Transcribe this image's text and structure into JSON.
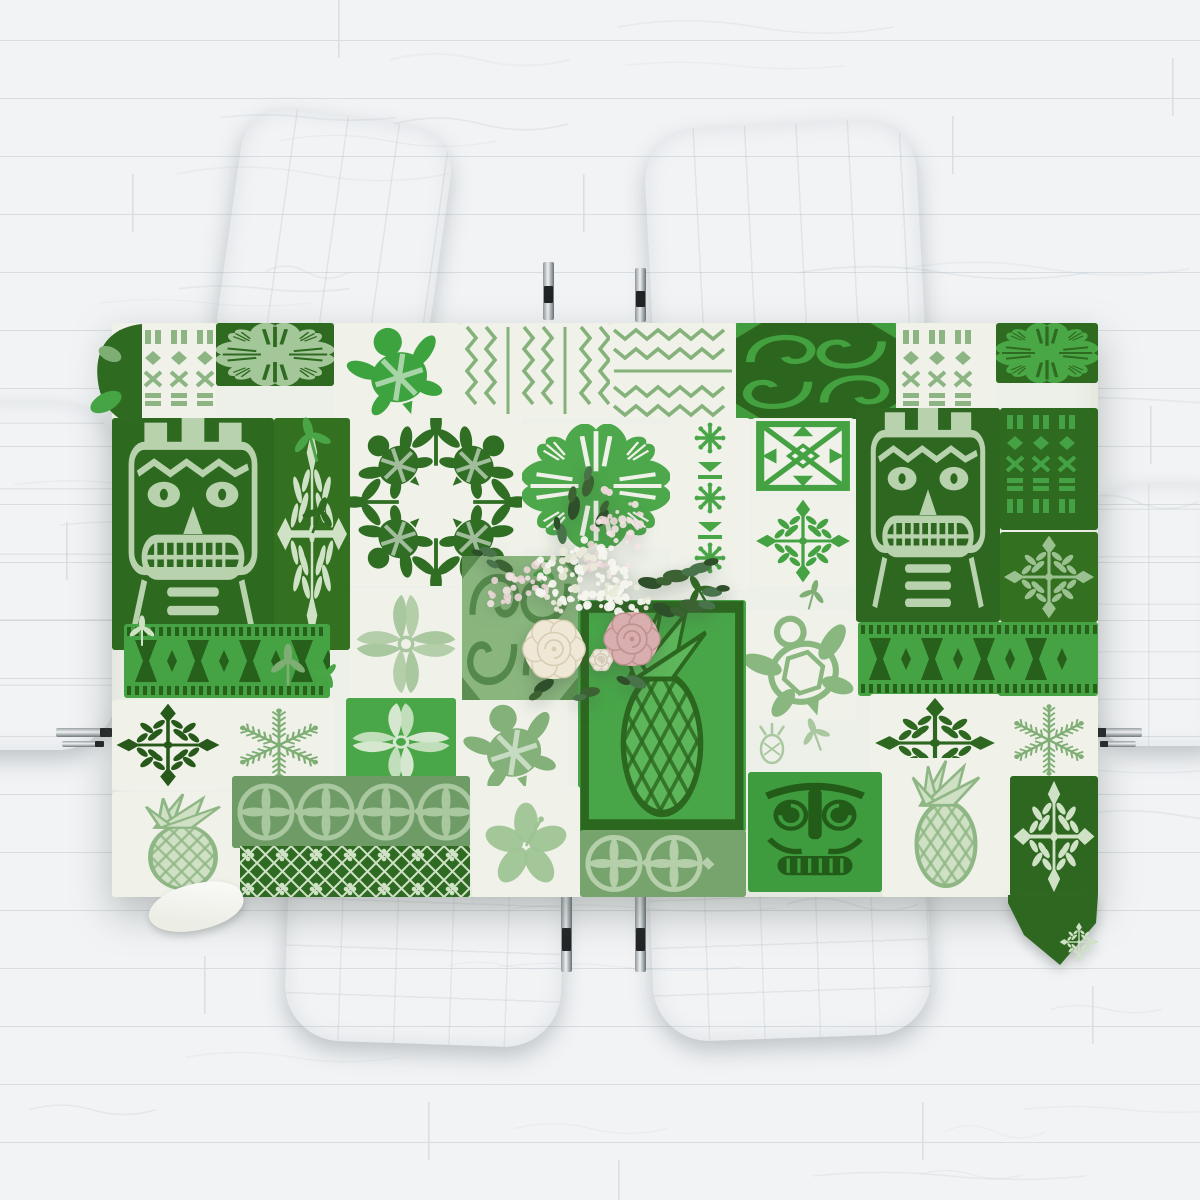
{
  "scene": {
    "kind": "tabletop-product-photo",
    "subject": "hawaiian-tapa-patchwork-tablecloth",
    "palette": {
      "floor_base": "#f1f3f5",
      "floor_seam": "#d7dde1",
      "floor_grain": "#c9d3d8",
      "chair_white": "#fafbfb",
      "chrome": "#b9bec2",
      "chrome_dark": "#202425",
      "cloth_base": "#edf0e8",
      "green_dark": "#2e6920",
      "green_bright": "#46a344",
      "green_sage": "#85b27b",
      "green_pale": "#cfe2c6",
      "rose_cream": "#efe8d6",
      "rose_pink": "#d9aeae",
      "foliage": "#3a5c33"
    }
  },
  "floor": {
    "base": "#f1f3f5",
    "seam": "#d7dde1",
    "grain": "#c9d3d8",
    "plank_height": 58,
    "joints": [
      {
        "x": 338,
        "y": 0
      },
      {
        "x": 1172,
        "y": 58
      },
      {
        "x": 132,
        "y": 174
      },
      {
        "x": 583,
        "y": 174
      },
      {
        "x": 952,
        "y": 116
      },
      {
        "x": 66,
        "y": 522
      },
      {
        "x": 1150,
        "y": 406
      },
      {
        "x": 204,
        "y": 956
      },
      {
        "x": 1092,
        "y": 986
      },
      {
        "x": 428,
        "y": 1102
      },
      {
        "x": 922,
        "y": 1102
      },
      {
        "x": 618,
        "y": 1160
      }
    ]
  },
  "chairs": [
    {
      "id": "chair-top-left",
      "x": 230,
      "y": 116,
      "w": 212,
      "h": 232,
      "rot": 8,
      "seams": "v",
      "radius": "46px 46px 16px 16px"
    },
    {
      "id": "chair-top-right",
      "x": 648,
      "y": 124,
      "w": 272,
      "h": 224,
      "rot": -3,
      "seams": "v",
      "radius": "52px 52px 16px 16px"
    },
    {
      "id": "chair-left-end",
      "x": -28,
      "y": 402,
      "w": 146,
      "h": 348,
      "rot": 0,
      "seams": "h",
      "radius": "22px 60px 60px 22px"
    },
    {
      "id": "chair-right-end",
      "x": 1094,
      "y": 484,
      "w": 120,
      "h": 262,
      "rot": 0,
      "seams": "g",
      "radius": "40px 10px 10px 40px"
    },
    {
      "id": "chair-bottom-left",
      "x": 286,
      "y": 878,
      "w": 276,
      "h": 166,
      "rot": 2,
      "seams": "g",
      "radius": "14px 14px 56px 56px"
    },
    {
      "id": "chair-bottom-right",
      "x": 652,
      "y": 878,
      "w": 278,
      "h": 160,
      "rot": -2,
      "seams": "g",
      "radius": "14px 14px 56px 56px"
    }
  ],
  "table_legs": [
    {
      "x": 543,
      "y": 262,
      "w": 11,
      "h": 58,
      "o": "v"
    },
    {
      "x": 635,
      "y": 268,
      "w": 11,
      "h": 54,
      "o": "v"
    },
    {
      "x": 561,
      "y": 896,
      "w": 11,
      "h": 76,
      "o": "v"
    },
    {
      "x": 635,
      "y": 896,
      "w": 11,
      "h": 76,
      "o": "v"
    },
    {
      "x": 56,
      "y": 728,
      "w": 56,
      "h": 9,
      "o": "h"
    },
    {
      "x": 62,
      "y": 741,
      "w": 42,
      "h": 6,
      "o": "h"
    },
    {
      "x": 1096,
      "y": 728,
      "w": 46,
      "h": 9,
      "o": "h"
    },
    {
      "x": 1100,
      "y": 741,
      "w": 36,
      "h": 6,
      "o": "h"
    }
  ],
  "tablecloth": {
    "x": 112,
    "y": 323,
    "width": 986,
    "height": 574,
    "base": "#edf0e8",
    "tiles": [
      {
        "x": 0,
        "y": 0,
        "w": 104,
        "h": 95,
        "bg": "#f0f2ea",
        "motif": "tiki-columns",
        "c": "#8db583"
      },
      {
        "x": 104,
        "y": 0,
        "w": 118,
        "h": 63,
        "bg": "#2f6a21",
        "motif": "monstera-quilt",
        "c": "#a4c79a"
      },
      {
        "x": 222,
        "y": 0,
        "w": 126,
        "h": 95,
        "bg": "#f0f2ea",
        "motif": "turtle",
        "c": "#3da33e"
      },
      {
        "x": 348,
        "y": 0,
        "w": 150,
        "h": 95,
        "bg": "#f0f2ea",
        "motif": "zigzag-v",
        "c": "#85b27b"
      },
      {
        "x": 498,
        "y": 0,
        "w": 126,
        "h": 95,
        "bg": "#f0f2ea",
        "motif": "zigzag-h",
        "c": "#85b27b"
      },
      {
        "x": 624,
        "y": 0,
        "w": 160,
        "h": 96,
        "bg": "#2c661e",
        "motif": "tapa-swirl",
        "c": "#43a23f"
      },
      {
        "x": 784,
        "y": 0,
        "w": 100,
        "h": 95,
        "bg": "#f0f2ea",
        "motif": "tiki-columns",
        "c": "#8db583"
      },
      {
        "x": 884,
        "y": 0,
        "w": 102,
        "h": 60,
        "bg": "#2f6a21",
        "motif": "monstera-quilt",
        "c": "#4aa746"
      },
      {
        "x": 0,
        "y": 95,
        "w": 162,
        "h": 232,
        "bg": "#2e6920",
        "motif": "tiki-face",
        "c": "#b7d2ac"
      },
      {
        "x": 162,
        "y": 95,
        "w": 76,
        "h": 232,
        "bg": "#33701f",
        "motif": "quilt-snowflake",
        "c": "#cfe2c6"
      },
      {
        "x": 238,
        "y": 95,
        "w": 172,
        "h": 168,
        "bg": "#f0f2ea",
        "motif": "turtle-ring",
        "c": "#2f6e23"
      },
      {
        "x": 410,
        "y": 101,
        "w": 148,
        "h": 124,
        "bg": "#f0f2ea",
        "motif": "monstera-quilt",
        "c": "#4ca84a"
      },
      {
        "x": 558,
        "y": 95,
        "w": 80,
        "h": 172,
        "bg": "#f0f2ea",
        "motif": "spider-columns",
        "c": "#49a647"
      },
      {
        "x": 640,
        "y": 95,
        "w": 102,
        "h": 76,
        "bg": "#f0f2ea",
        "motif": "tapa-x",
        "c": "#45a243"
      },
      {
        "x": 640,
        "y": 173,
        "w": 102,
        "h": 90,
        "bg": "#f0f2ea",
        "motif": "quilt-snowflake",
        "c": "#45a243"
      },
      {
        "x": 744,
        "y": 85,
        "w": 144,
        "h": 214,
        "bg": "#2d6720",
        "motif": "tiki-face",
        "c": "#b7d2ac"
      },
      {
        "x": 888,
        "y": 85,
        "w": 98,
        "h": 122,
        "bg": "#2f6a21",
        "motif": "tiki-columns",
        "c": "#45a244"
      },
      {
        "x": 888,
        "y": 209,
        "w": 98,
        "h": 90,
        "bg": "#33701f",
        "motif": "quilt-snowflake",
        "c": "#9cc191"
      },
      {
        "x": 238,
        "y": 265,
        "w": 112,
        "h": 112,
        "bg": "#f0f2ea",
        "motif": "leaf-cross",
        "c": "#a9c89f"
      },
      {
        "x": 350,
        "y": 233,
        "w": 116,
        "h": 144,
        "bg": "#8ab67e",
        "motif": "tapa-swirl",
        "c": "#55894b"
      },
      {
        "x": 466,
        "y": 277,
        "w": 168,
        "h": 232,
        "bg": "#48a648",
        "motif": "pineapple",
        "c": "#5db65a",
        "c2": "#2c671f"
      },
      {
        "x": 634,
        "y": 287,
        "w": 110,
        "h": 110,
        "bg": "#f0f2ea",
        "motif": "turtle-outline",
        "c": "#8ab77f"
      },
      {
        "x": 746,
        "y": 299,
        "w": 240,
        "h": 74,
        "bg": "#46a344",
        "motif": "hourglass",
        "c": "#27601b"
      },
      {
        "x": 12,
        "y": 301,
        "w": 206,
        "h": 74,
        "bg": "#46a344",
        "motif": "hourglass",
        "c": "#27601b"
      },
      {
        "x": 0,
        "y": 377,
        "w": 112,
        "h": 90,
        "bg": "#f0f2ea",
        "motif": "quilt-snowflake",
        "c": "#27591b"
      },
      {
        "x": 112,
        "y": 377,
        "w": 110,
        "h": 90,
        "bg": "#f0f2ea",
        "motif": "fern-snowflake",
        "c": "#7fae74"
      },
      {
        "x": 234,
        "y": 375,
        "w": 110,
        "h": 88,
        "bg": "#4aa748",
        "motif": "leaf-cross",
        "c": "#d6e7cf"
      },
      {
        "x": 344,
        "y": 377,
        "w": 112,
        "h": 92,
        "bg": "#f0f2ea",
        "motif": "turtle",
        "c": "#84b179"
      },
      {
        "x": 758,
        "y": 371,
        "w": 130,
        "h": 98,
        "bg": "#f0f2ea",
        "motif": "quilt-snowflake",
        "c": "#2d6720"
      },
      {
        "x": 888,
        "y": 373,
        "w": 98,
        "h": 88,
        "bg": "#f0f2ea",
        "motif": "fern-snowflake",
        "c": "#7fae74"
      },
      {
        "x": 0,
        "y": 469,
        "w": 142,
        "h": 105,
        "bg": "#f0f2ea",
        "motif": "pineapple",
        "c": "#cfe0c5",
        "c2": "#8fb785"
      },
      {
        "x": 120,
        "y": 453,
        "w": 238,
        "h": 72,
        "bg": "#6f9c66",
        "motif": "medallion-band",
        "c": "#aac8a0"
      },
      {
        "x": 128,
        "y": 523,
        "w": 230,
        "h": 51,
        "bg": "#2f6a22",
        "motif": "lattice",
        "c": "#cfe2c6"
      },
      {
        "x": 360,
        "y": 463,
        "w": 108,
        "h": 111,
        "bg": "#f0f2ea",
        "motif": "hibiscus",
        "c": "#9dc393"
      },
      {
        "x": 468,
        "y": 507,
        "w": 166,
        "h": 67,
        "bg": "#76a46c",
        "motif": "medallion-band",
        "c": "#b5cfab"
      },
      {
        "x": 636,
        "y": 449,
        "w": 134,
        "h": 120,
        "bg": "#3f9c3e",
        "motif": "tiki-mask",
        "c": "#235c19"
      },
      {
        "x": 770,
        "y": 435,
        "w": 128,
        "h": 139,
        "bg": "#f0f2ea",
        "motif": "pineapple",
        "c": "#cfe0c5",
        "c2": "#8fb785"
      },
      {
        "x": 898,
        "y": 453,
        "w": 88,
        "h": 121,
        "bg": "#2e6820",
        "motif": "quilt-snowflake",
        "c": "#cfe2c6"
      }
    ],
    "scatter": [
      {
        "x": 200,
        "y": 120,
        "motif": "sprig",
        "c": "#4aa546",
        "s": 1.2,
        "r": -15
      },
      {
        "x": 206,
        "y": 195,
        "motif": "sprig",
        "c": "#2f6a21",
        "s": 1.0,
        "r": 20
      },
      {
        "x": 176,
        "y": 345,
        "motif": "sprig",
        "c": "#7fae74",
        "s": 1.1,
        "r": 0
      },
      {
        "x": 212,
        "y": 355,
        "motif": "sprig",
        "c": "#4aa546",
        "s": 0.8,
        "r": 40
      },
      {
        "x": 590,
        "y": 272,
        "motif": "sprig",
        "c": "#2f6a21",
        "s": 1.0,
        "r": -30
      },
      {
        "x": 700,
        "y": 274,
        "motif": "sprig",
        "c": "#7fae74",
        "s": 0.8,
        "r": 15
      },
      {
        "x": 432,
        "y": 252,
        "motif": "sprig",
        "c": "#4aa546",
        "s": 0.7,
        "r": 10
      },
      {
        "x": 660,
        "y": 420,
        "motif": "pineapple-small",
        "c": "#a9c89f",
        "s": 1.0,
        "r": 0
      },
      {
        "x": 704,
        "y": 414,
        "motif": "sprig",
        "c": "#a9c89f",
        "s": 0.9,
        "r": -20
      },
      {
        "x": 30,
        "y": 310,
        "motif": "sprig",
        "c": "#cfe2c6",
        "s": 0.8,
        "r": 0
      }
    ],
    "drape_bottom_right": {
      "points": "896,572 986,572 984,600 948,642 912,612 896,580",
      "fill": "#2e6820"
    },
    "corner_bump_top_left": {
      "fill": "#2f6a21",
      "leaf": "#47a445"
    }
  },
  "bouquet": {
    "x": 450,
    "y": 450,
    "w": 300,
    "h": 270,
    "gyp_clusters": [
      {
        "cx": 130,
        "cy": 126,
        "r": 46,
        "n": 95
      },
      {
        "cx": 180,
        "cy": 152,
        "r": 22,
        "n": 28
      }
    ],
    "astilbe": [
      {
        "cx": 165,
        "cy": 84,
        "rx": 26,
        "ry": 42,
        "rot": 18,
        "n": 46
      },
      {
        "cx": 66,
        "cy": 136,
        "rx": 34,
        "ry": 16,
        "rot": -18,
        "n": 30
      }
    ],
    "roses": [
      {
        "cx": 104,
        "cy": 199,
        "r": 30,
        "fill": "#efe8d6",
        "swirl": "#d8cdb2",
        "name": "cream-rose"
      },
      {
        "cx": 182,
        "cy": 189,
        "r": 27,
        "fill": "#d9aeae",
        "swirl": "#c09090",
        "name": "pink-rose"
      },
      {
        "cx": 151,
        "cy": 210,
        "r": 11,
        "fill": "#ece7da",
        "swirl": "#d4ccb8",
        "name": "white-rosebud"
      }
    ],
    "leaves": [
      {
        "x": 200,
        "y": 133,
        "rot": 10,
        "len": 24
      },
      {
        "x": 226,
        "y": 126,
        "rot": 0,
        "len": 26
      },
      {
        "x": 250,
        "y": 118,
        "rot": -10,
        "len": 22
      },
      {
        "x": 214,
        "y": 160,
        "rot": 25,
        "len": 24
      },
      {
        "x": 242,
        "y": 156,
        "rot": 12,
        "len": 26
      },
      {
        "x": 262,
        "y": 142,
        "rot": 2,
        "len": 20
      },
      {
        "x": 124,
        "y": 58,
        "rot": -80,
        "len": 24
      },
      {
        "x": 138,
        "y": 36,
        "rot": -72,
        "len": 22
      },
      {
        "x": 112,
        "y": 84,
        "rot": -95,
        "len": 20
      },
      {
        "x": 152,
        "y": 68,
        "rot": -58,
        "len": 20
      },
      {
        "x": 54,
        "y": 116,
        "rot": -150,
        "len": 20
      },
      {
        "x": 38,
        "y": 102,
        "rot": -162,
        "len": 18
      },
      {
        "x": 94,
        "y": 236,
        "rot": 150,
        "len": 22
      },
      {
        "x": 140,
        "y": 242,
        "rot": 172,
        "len": 20
      },
      {
        "x": 186,
        "y": 232,
        "rot": 205,
        "len": 22
      }
    ],
    "leaf_colors": [
      "#2f4f2a",
      "#3c6233",
      "#49734b"
    ]
  }
}
